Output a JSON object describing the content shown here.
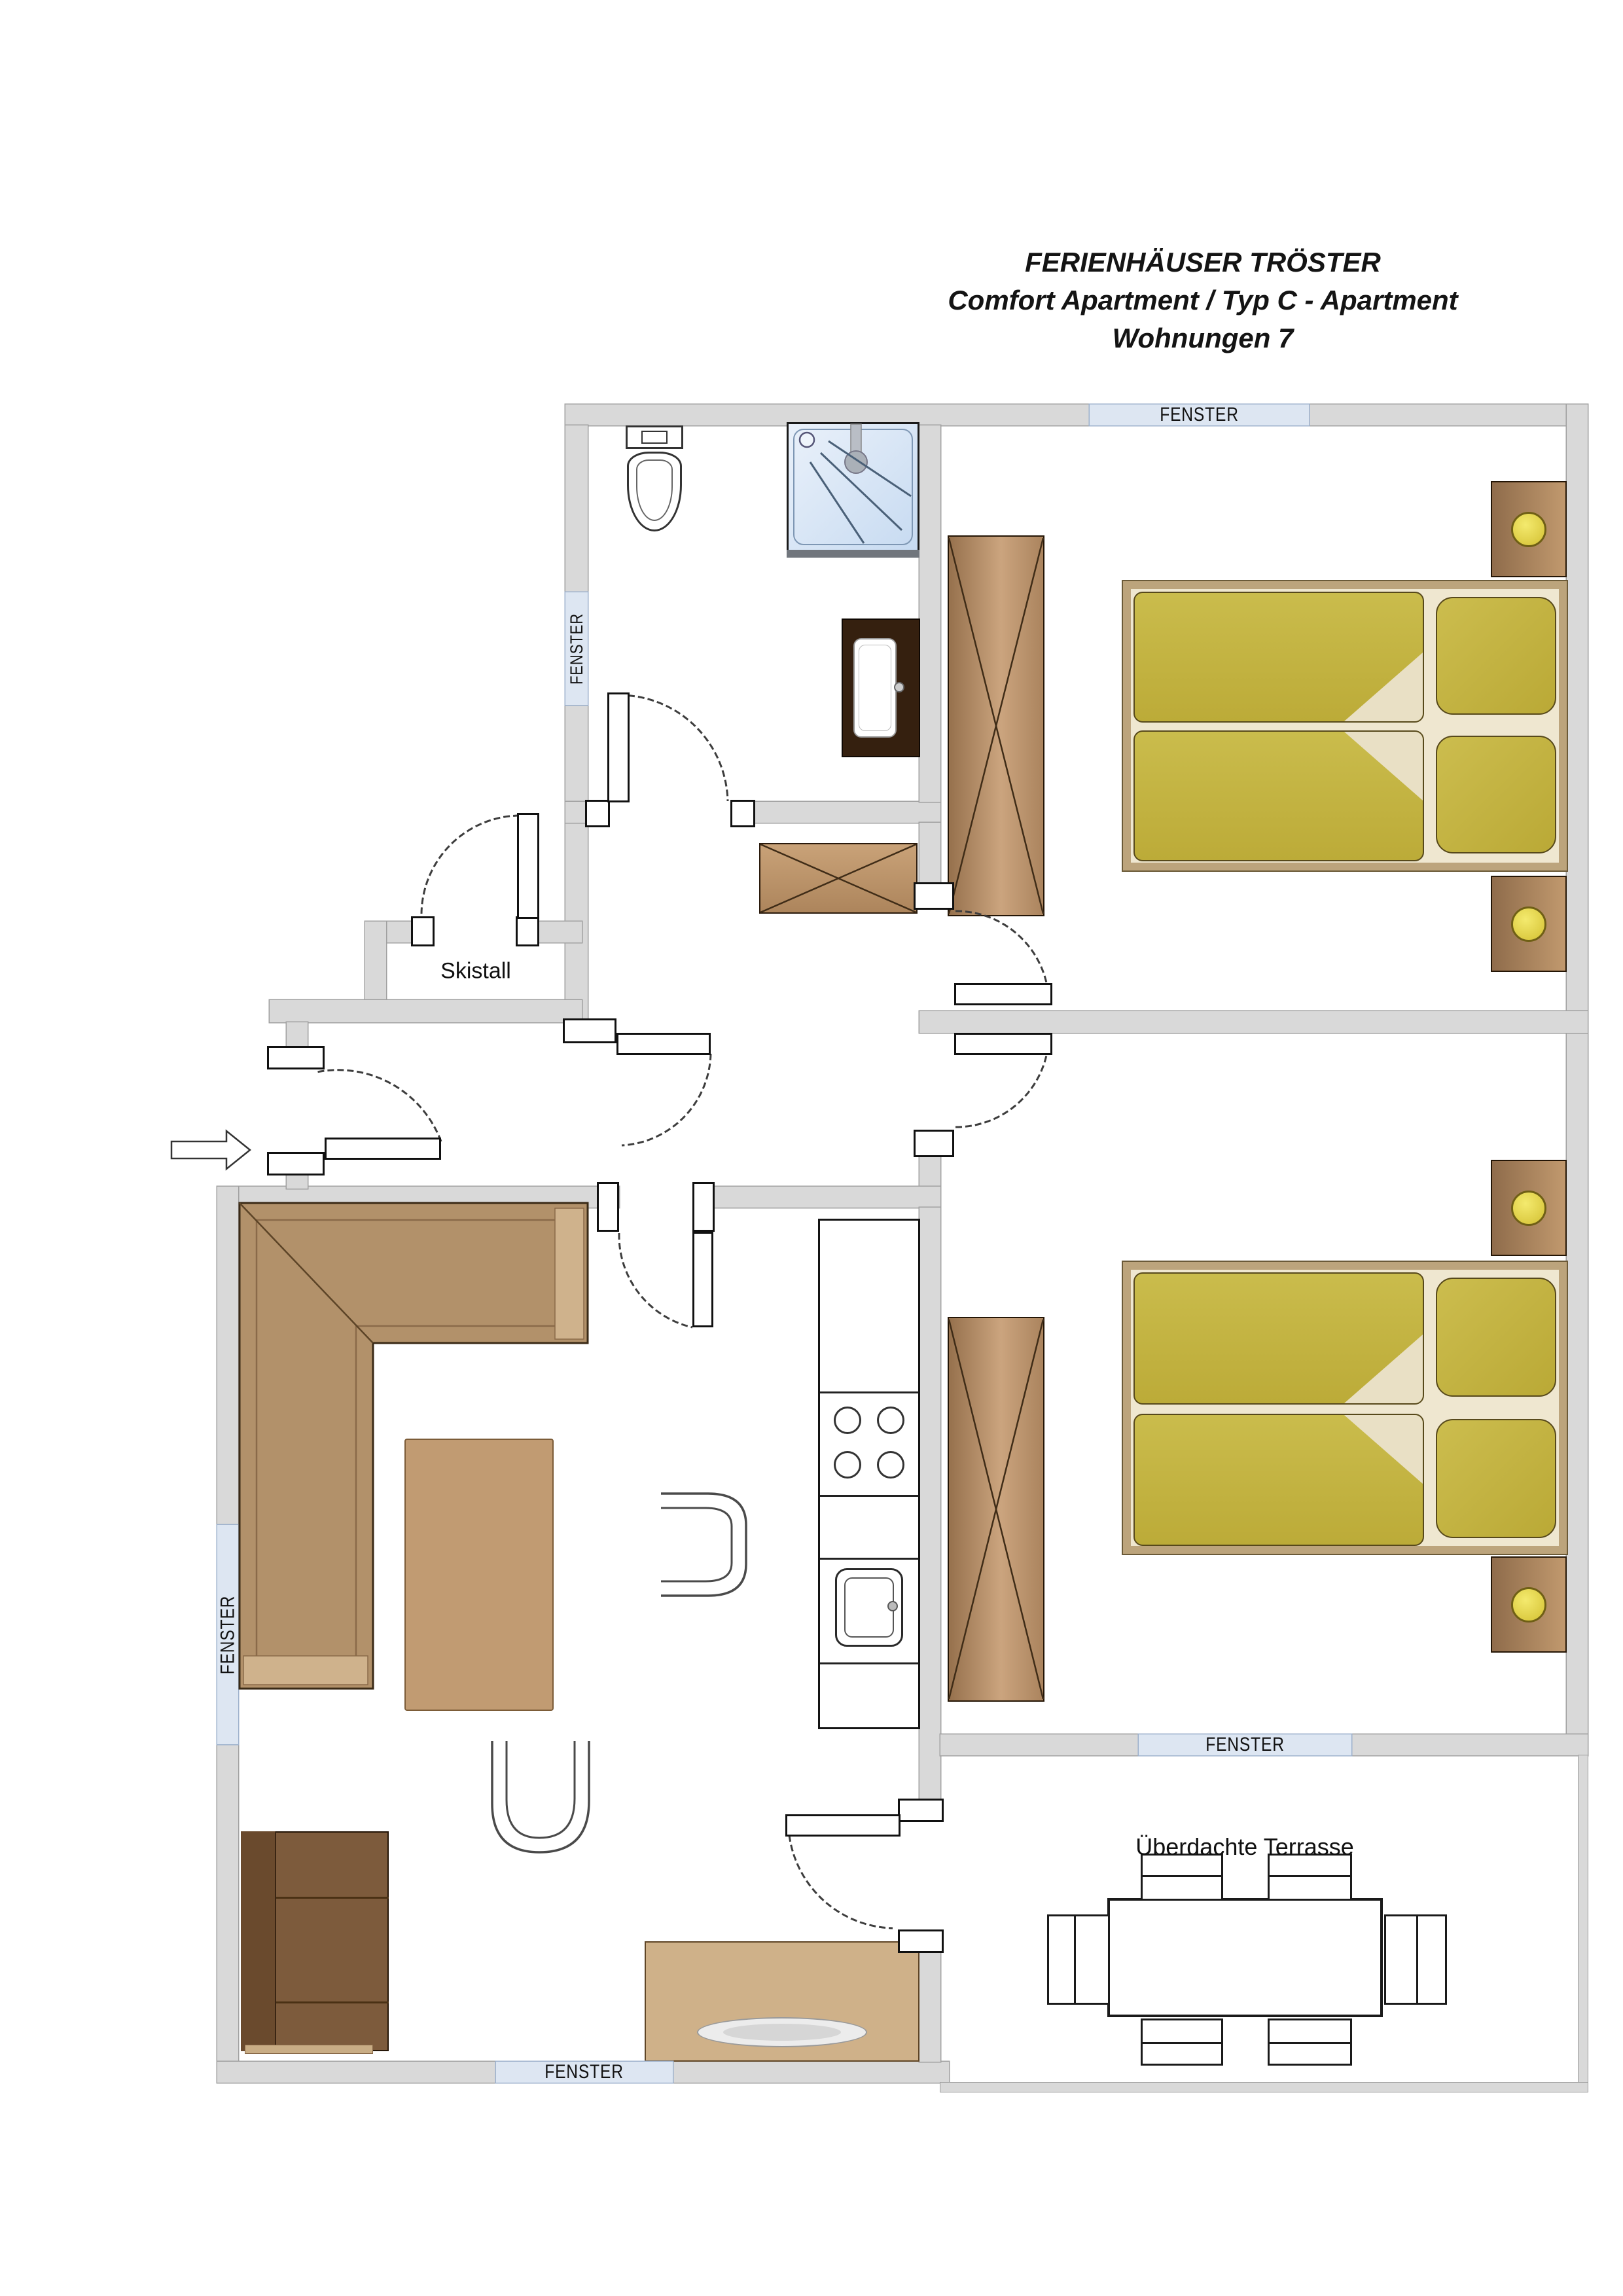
{
  "title": {
    "line1": "FERIENHÄUSER TRÖSTER",
    "line2": "Comfort Apartment / Typ C - Apartment",
    "line3": "Wohnungen 7"
  },
  "labels": {
    "window": "FENSTER",
    "ski_storage_room": "Skistall",
    "covered_terrace": "Überdachte Terrasse"
  },
  "windows": [
    "top-wall",
    "bathroom-left-wall",
    "living-left-wall",
    "living-bottom-wall",
    "terrace-top-wall"
  ],
  "rooms": [
    "bathroom",
    "bedroom-1",
    "bedroom-2",
    "hallway",
    "living-kitchen",
    "ski-storage",
    "covered-terrace"
  ],
  "colors": {
    "wall": "#d9d9d9",
    "window_band": "#dde6f2",
    "wood_dark": "#7d5b3c",
    "wood_mid": "#b2916a",
    "wood_light": "#cfb189",
    "bed_duvet": "#c3b13e",
    "bed_sheet": "#efe7d0",
    "lamp_yellow": "#e8d84a",
    "shower_blue": "#cfe0f4"
  }
}
